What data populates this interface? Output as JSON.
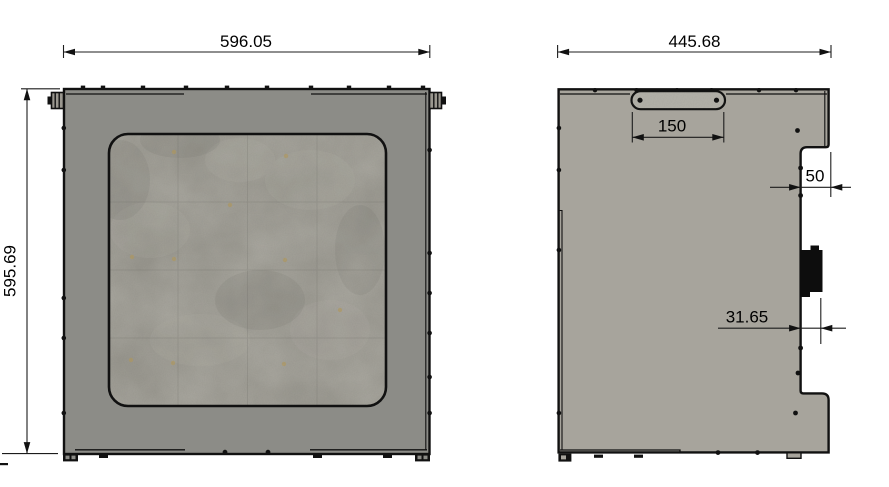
{
  "drawing": {
    "views": {
      "front": {
        "width_label": "596.05",
        "height_label": "595.69"
      },
      "side": {
        "width_label": "445.68",
        "handle_width_label": "150",
        "step_width_label": "50",
        "connector_offset_label": "31.65"
      }
    },
    "colors": {
      "background": "#ffffff",
      "front_panel": "#8c8c87",
      "side_panel": "#a7a49c",
      "window": "#98968e",
      "handle": "#b4b2aa",
      "connector": "#0d0d0d"
    }
  }
}
